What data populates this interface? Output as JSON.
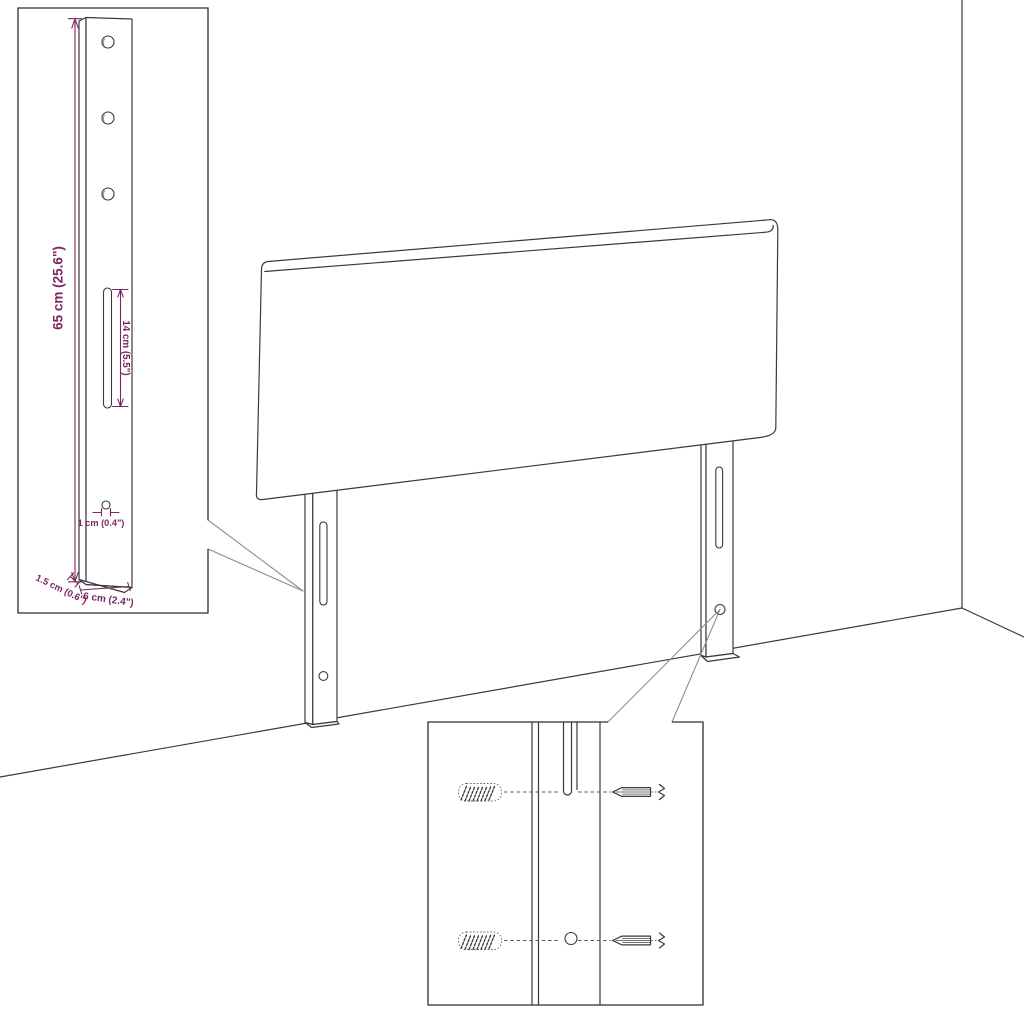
{
  "diagram": {
    "dims": {
      "height": {
        "label": "65 cm (25.6\")"
      },
      "slot": {
        "label": "14 cm (5.5\")"
      },
      "hole": {
        "label": "1 cm (0.4\")"
      },
      "thickness": {
        "label": "1.5 cm (0.6\")"
      },
      "width": {
        "label": "6 cm (2.4\")"
      }
    },
    "colors": {
      "dimension": "#7b2661",
      "line": "#3a3a3a",
      "leader": "#8f8f8f",
      "background": "#ffffff"
    }
  }
}
